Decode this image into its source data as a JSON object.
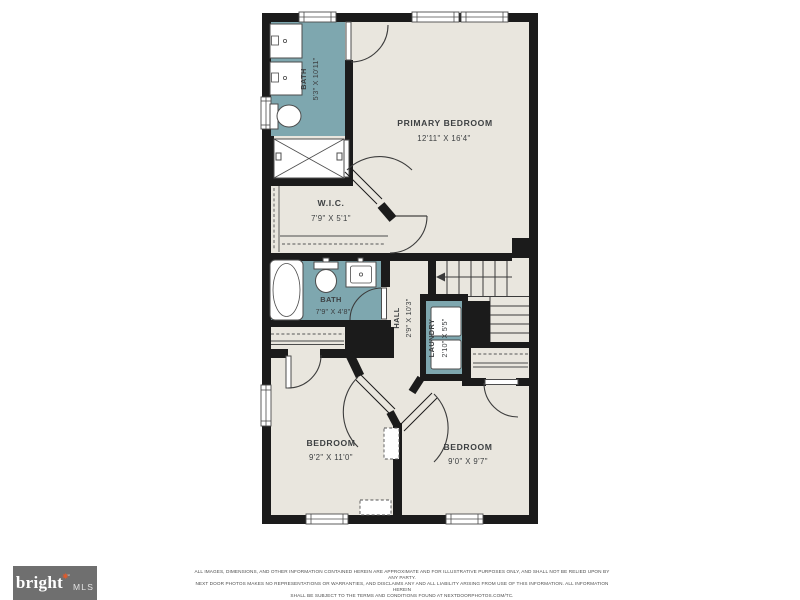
{
  "floor_plan": {
    "colors": {
      "wall": "#1b1b1b",
      "floor": "#e9e6de",
      "wet_room_teal": "#7ea7af",
      "background": "#ffffff",
      "label_text": "#3d4042"
    },
    "rooms": [
      {
        "id": "bath-upper",
        "name": "BATH",
        "dims": "5'3\" X 10'11\""
      },
      {
        "id": "primary-bedroom",
        "name": "PRIMARY BEDROOM",
        "dims": "12'11\" X 16'4\""
      },
      {
        "id": "wic",
        "name": "W.I.C.",
        "dims": "7'9\" X 5'1\""
      },
      {
        "id": "bath-middle",
        "name": "BATH",
        "dims": "7'9\" X 4'8\""
      },
      {
        "id": "hall",
        "name": "HALL",
        "dims": "2'9\" X 10'3\""
      },
      {
        "id": "laundry",
        "name": "LAUNDRY",
        "dims": "2'10\" X 5'5\""
      },
      {
        "id": "bedroom-left",
        "name": "BEDROOM",
        "dims": "9'2\" X 11'0\""
      },
      {
        "id": "bedroom-right",
        "name": "BEDROOM",
        "dims": "9'0\" X 9'7\""
      }
    ]
  },
  "footer": {
    "logo": {
      "brand": "bright",
      "star": "✷",
      "trademark": "™",
      "suffix": "MLS"
    },
    "disclaimer": [
      "ALL IMAGES, DIMENSIONS, AND OTHER INFORMATION CONTAINED HEREIN ARE APPROXIMATE AND FOR ILLUSTRATIVE PURPOSES ONLY, AND SHALL NOT BE RELIED UPON BY ANY PARTY.",
      "NEXT DOOR PHOTOS MAKES NO REPRESENTATIONS OR WARRANTIES, AND DISCLAIMS ANY AND ALL LIABILITY ARISING FROM USE OF THIS INFORMATION. ALL INFORMATION HEREIN",
      "SHALL BE SUBJECT TO THE TERMS AND CONDITIONS FOUND AT NEXTDOORPHOTOS.COM/TC."
    ]
  }
}
